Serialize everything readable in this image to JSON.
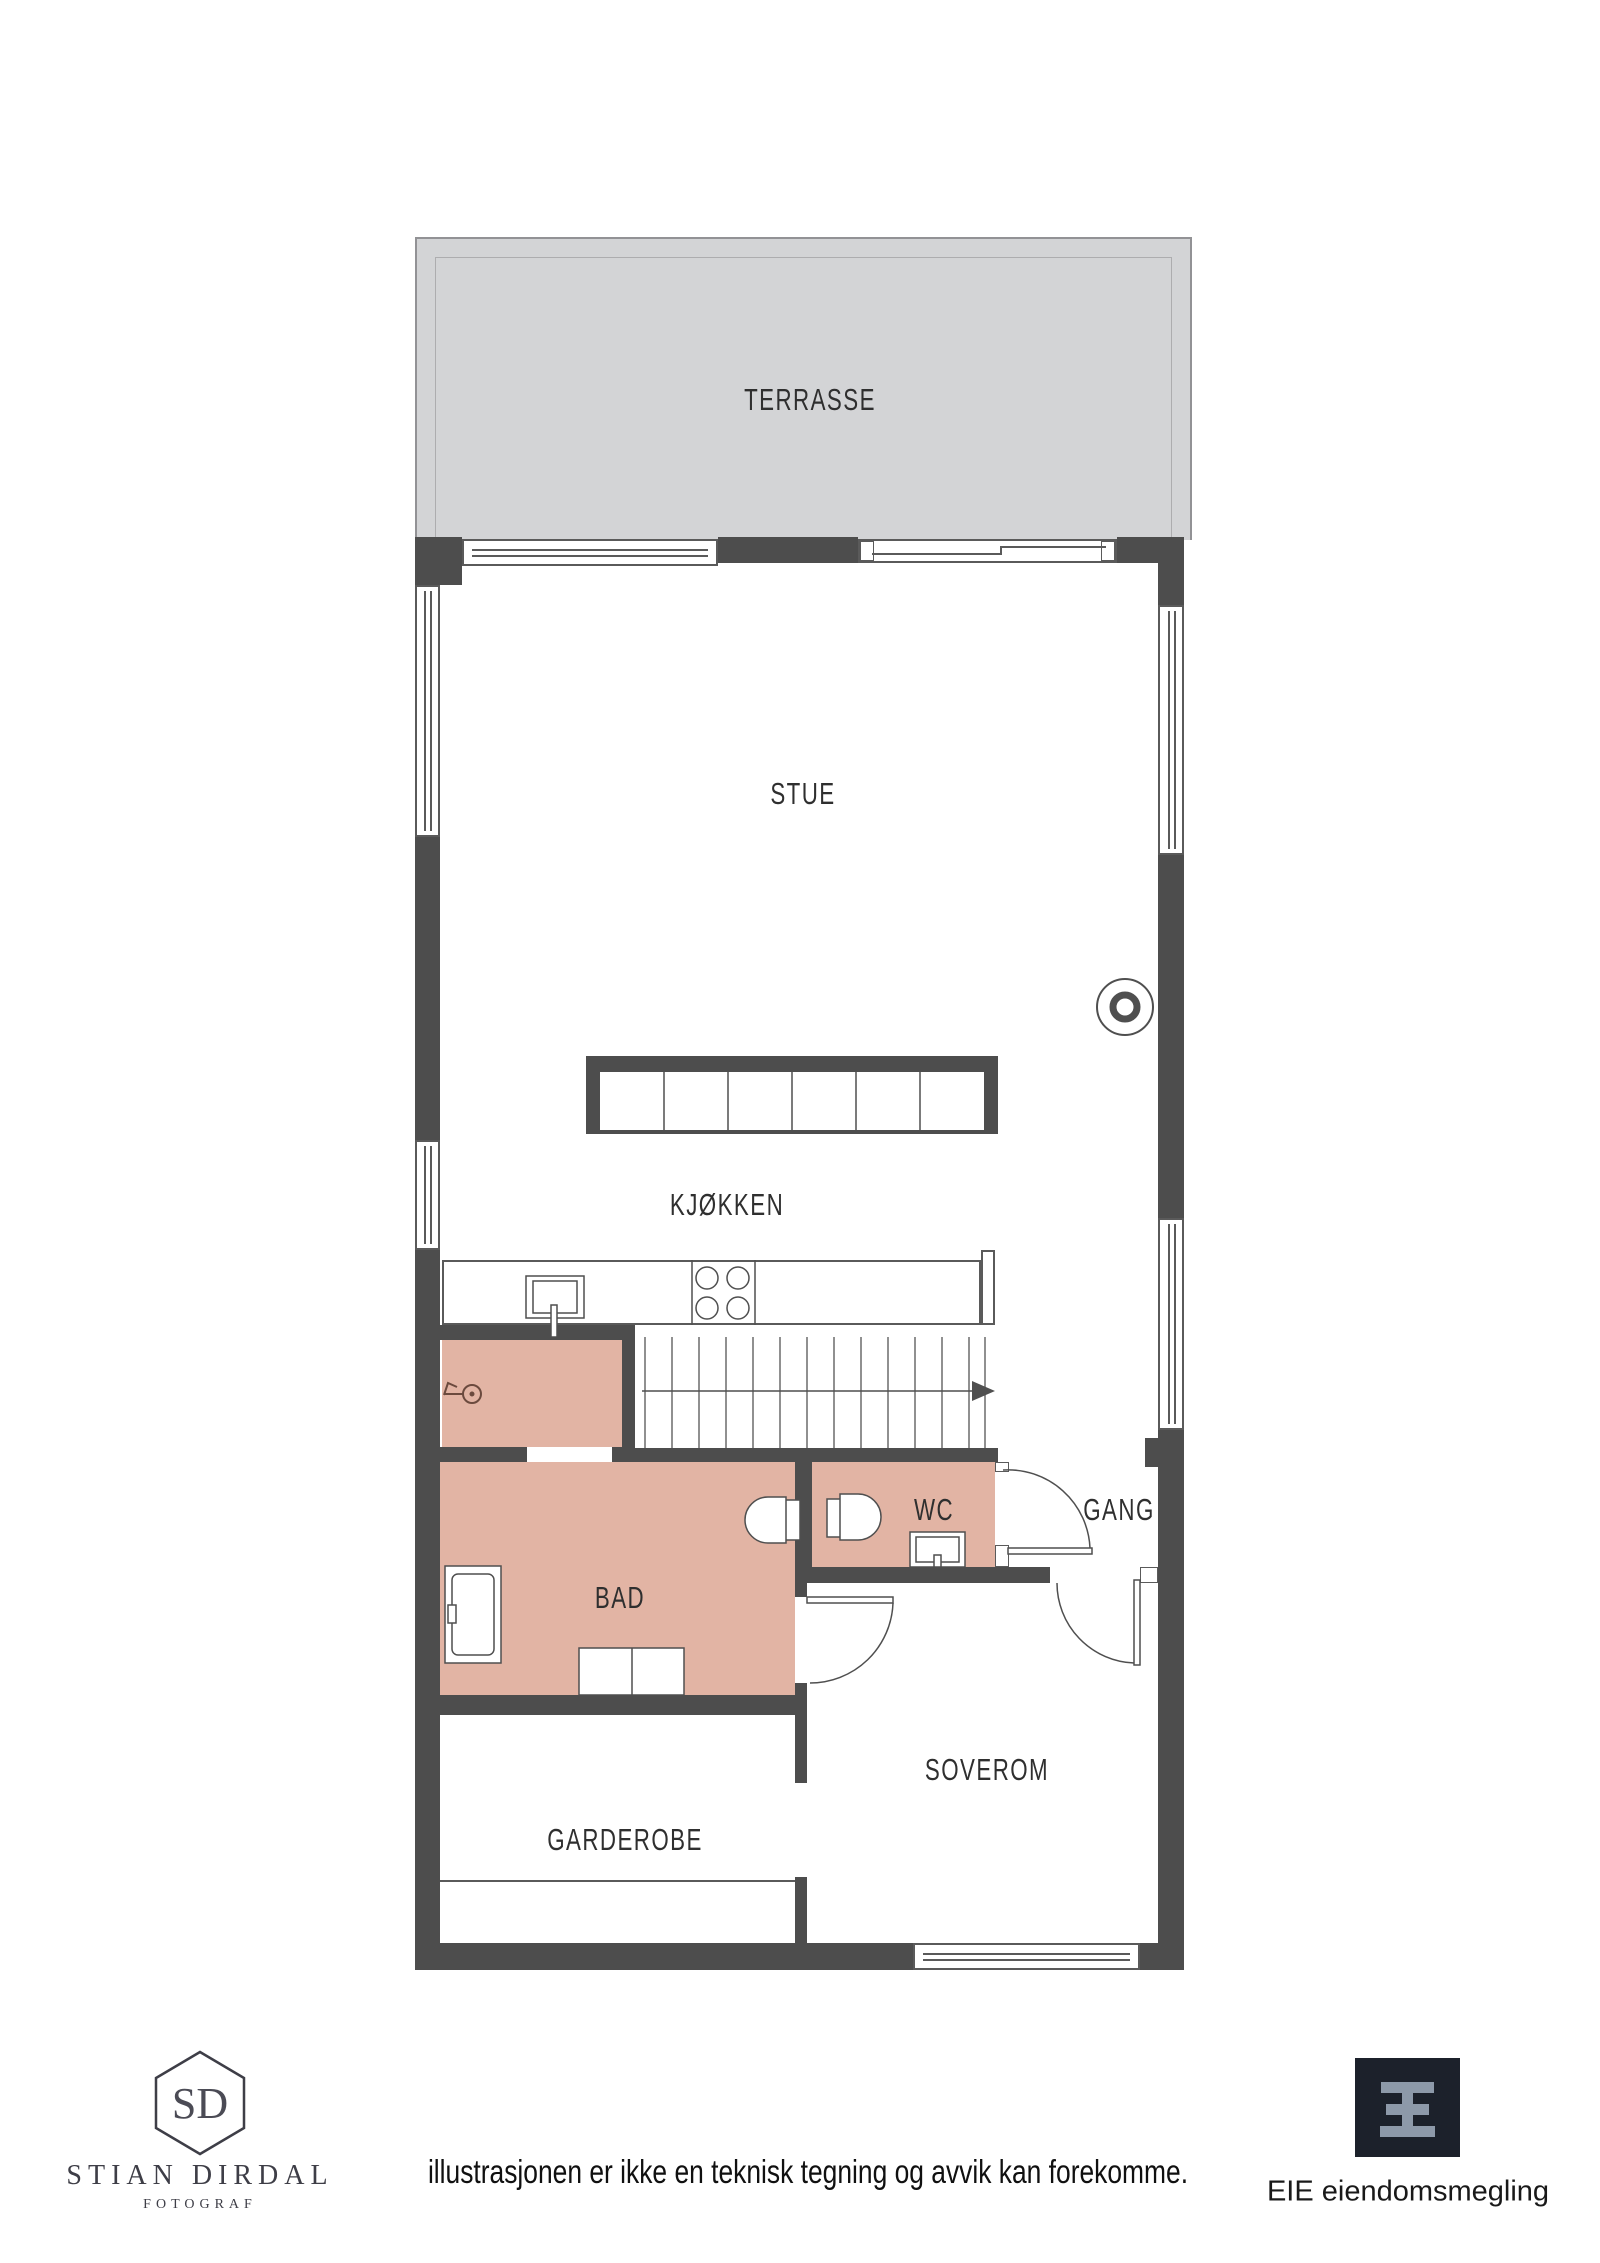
{
  "floor_plan": {
    "rooms": {
      "terrasse": "TERRASSE",
      "stue": "STUE",
      "kjokken": "KJØKKEN",
      "bad": "BAD",
      "wc": "WC",
      "gang": "GANG",
      "soverom": "SOVEROM",
      "garderobe": "GARDEROBE"
    },
    "colors": {
      "wall": "#4d4d4d",
      "wet_room_fill": "#e2b4a4",
      "terrace_fill": "#d3d4d6",
      "drawing_line": "#4f4f4f"
    },
    "icons": [
      "fireplace-icon",
      "stairs-direction-arrow-icon",
      "kitchen-sink-icon",
      "cooktop-icon",
      "shower-icon",
      "toilet-icon",
      "wash-basin-icon",
      "water-outlet-icon"
    ]
  },
  "footer": {
    "photographer": {
      "initials": "SD",
      "name": "STIAN DIRDAL",
      "role": "FOTOGRAF"
    },
    "disclaimer": "illustrasjonen er ikke en teknisk tegning og avvik kan forekomme.",
    "agency": {
      "name": "EIE eiendomsmegling"
    }
  }
}
